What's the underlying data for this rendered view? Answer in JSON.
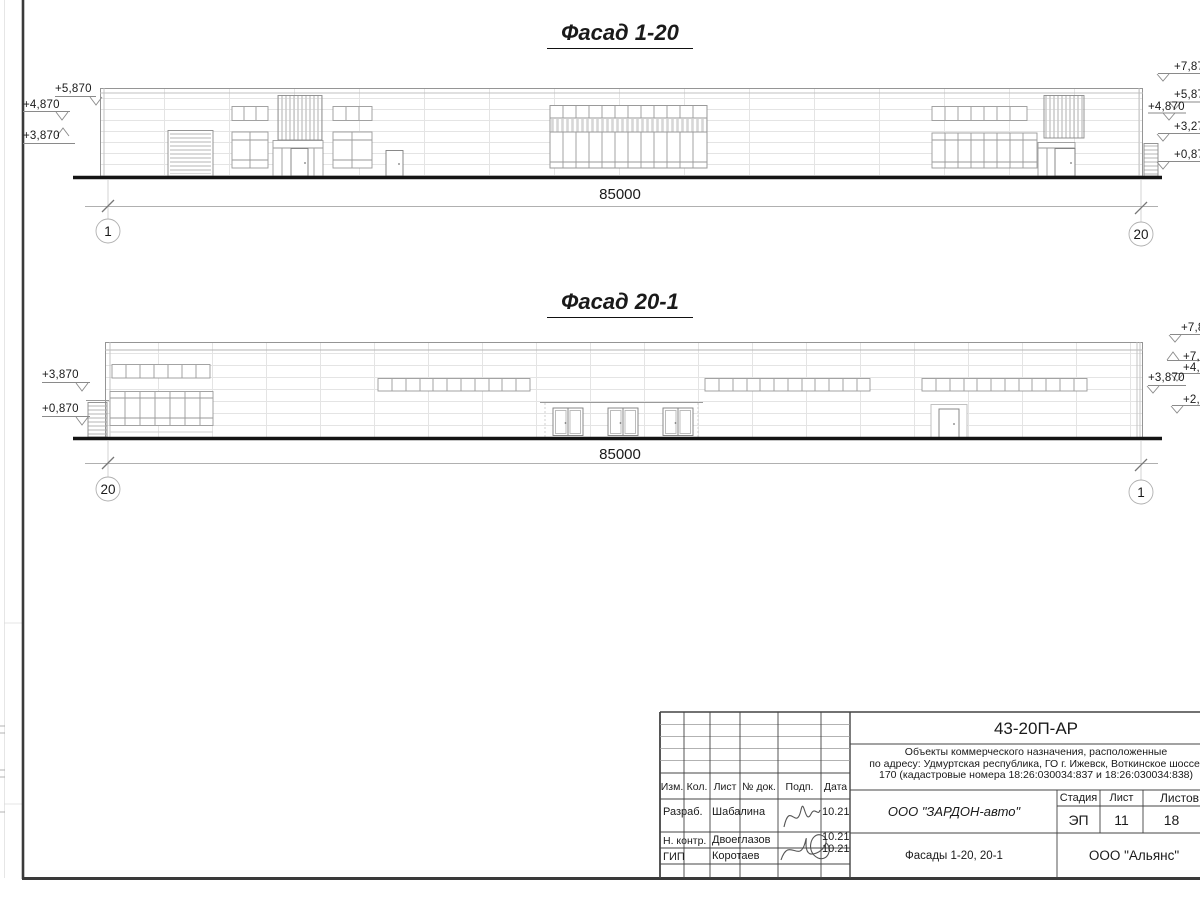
{
  "sheet": {
    "facade_top": {
      "title": "Фасад 1-20",
      "dimension": "85000",
      "axis_left": "1",
      "axis_right": "20",
      "marks_left": [
        "+5,870",
        "+4,870",
        "+3,870"
      ],
      "marks_right": [
        "+7,87",
        "+5,87",
        "+4,870",
        "+3,27",
        "+0,87"
      ]
    },
    "facade_bottom": {
      "title": "Фасад 20-1",
      "dimension": "85000",
      "axis_left": "20",
      "axis_right": "1",
      "marks_left": [
        "+3,870",
        "+0,870"
      ],
      "marks_right": [
        "+7,8",
        "+7,",
        "+4,8",
        "+3,870",
        "+2,1"
      ]
    },
    "title_block": {
      "doc_number": "43-20П-АР",
      "description_lines": [
        "Объекты коммерческого назначения, расположенные",
        "по адресу: Удмуртская республика, ГО г. Ижевск, Воткинское шоссе,",
        "170 (кадастровые номера 18:26:030034:837 и 18:26:030034:838)"
      ],
      "col_headers": {
        "izm": "Изм.",
        "kol": "Кол.",
        "list": "Лист",
        "doc": "№ док.",
        "podp": "Подп.",
        "data": "Дата"
      },
      "staff": [
        {
          "role": "Разраб.",
          "name": "Шабалина",
          "date": "10.21"
        },
        {
          "role": "Н. контр.",
          "name": "Двоеглазов",
          "date": "10.21"
        },
        {
          "role": "ГИП",
          "name": "Коротаев",
          "date": "10.21"
        }
      ],
      "client": "ООО \"ЗАРДОН-авто\"",
      "sheet_name": "Фасады 1-20, 20-1",
      "organization": "ООО \"Альянс\"",
      "stage_header": "Стадия",
      "list_header": "Лист",
      "listov_header": "Листов",
      "stage": "ЭП",
      "list_no": "11",
      "listov": "18"
    }
  }
}
